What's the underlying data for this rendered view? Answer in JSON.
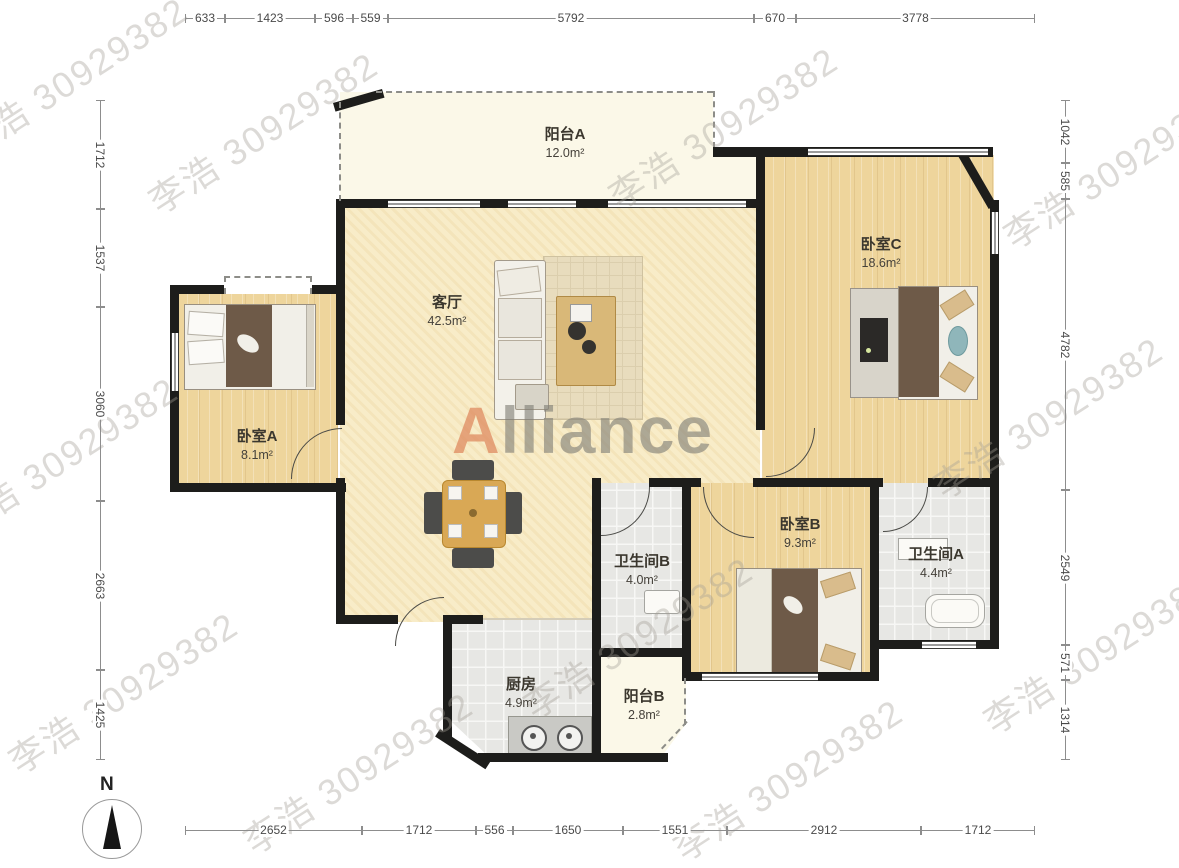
{
  "watermark": {
    "text": "李浩 30929382"
  },
  "logo": {
    "accent": "A",
    "rest": "lliance"
  },
  "compass": {
    "label": "N"
  },
  "rooms": {
    "balcony_a": {
      "name": "阳台A",
      "area": "12.0m²"
    },
    "bedroom_c": {
      "name": "卧室C",
      "area": "18.6m²"
    },
    "living_room": {
      "name": "客厅",
      "area": "42.5m²"
    },
    "bedroom_a": {
      "name": "卧室A",
      "area": "8.1m²"
    },
    "bathroom_b": {
      "name": "卫生间B",
      "area": "4.0m²"
    },
    "bedroom_b": {
      "name": "卧室B",
      "area": "9.3m²"
    },
    "bathroom_a": {
      "name": "卫生间A",
      "area": "4.4m²"
    },
    "kitchen": {
      "name": "厨房",
      "area": "4.9m²"
    },
    "balcony_b": {
      "name": "阳台B",
      "area": "2.8m²"
    }
  },
  "dimensions": {
    "top": [
      "633",
      "1423",
      "596",
      "559",
      "5792",
      "670",
      "3778"
    ],
    "left": [
      "1712",
      "1537",
      "3060",
      "2663",
      "1425"
    ],
    "right": [
      "1042",
      "585",
      "4782",
      "2549",
      "571",
      "1314"
    ],
    "bottom": [
      "2652",
      "1712",
      "556",
      "1650",
      "1551",
      "2912",
      "1712"
    ]
  },
  "colors": {
    "wall": "#1d1d1b",
    "wood_floor": "#eed59c",
    "tile_floor": "#e7e7e4",
    "living_floor": "#f8ecc8",
    "balcony_floor": "#fbf8e8",
    "logo_accent": "#de865c"
  }
}
